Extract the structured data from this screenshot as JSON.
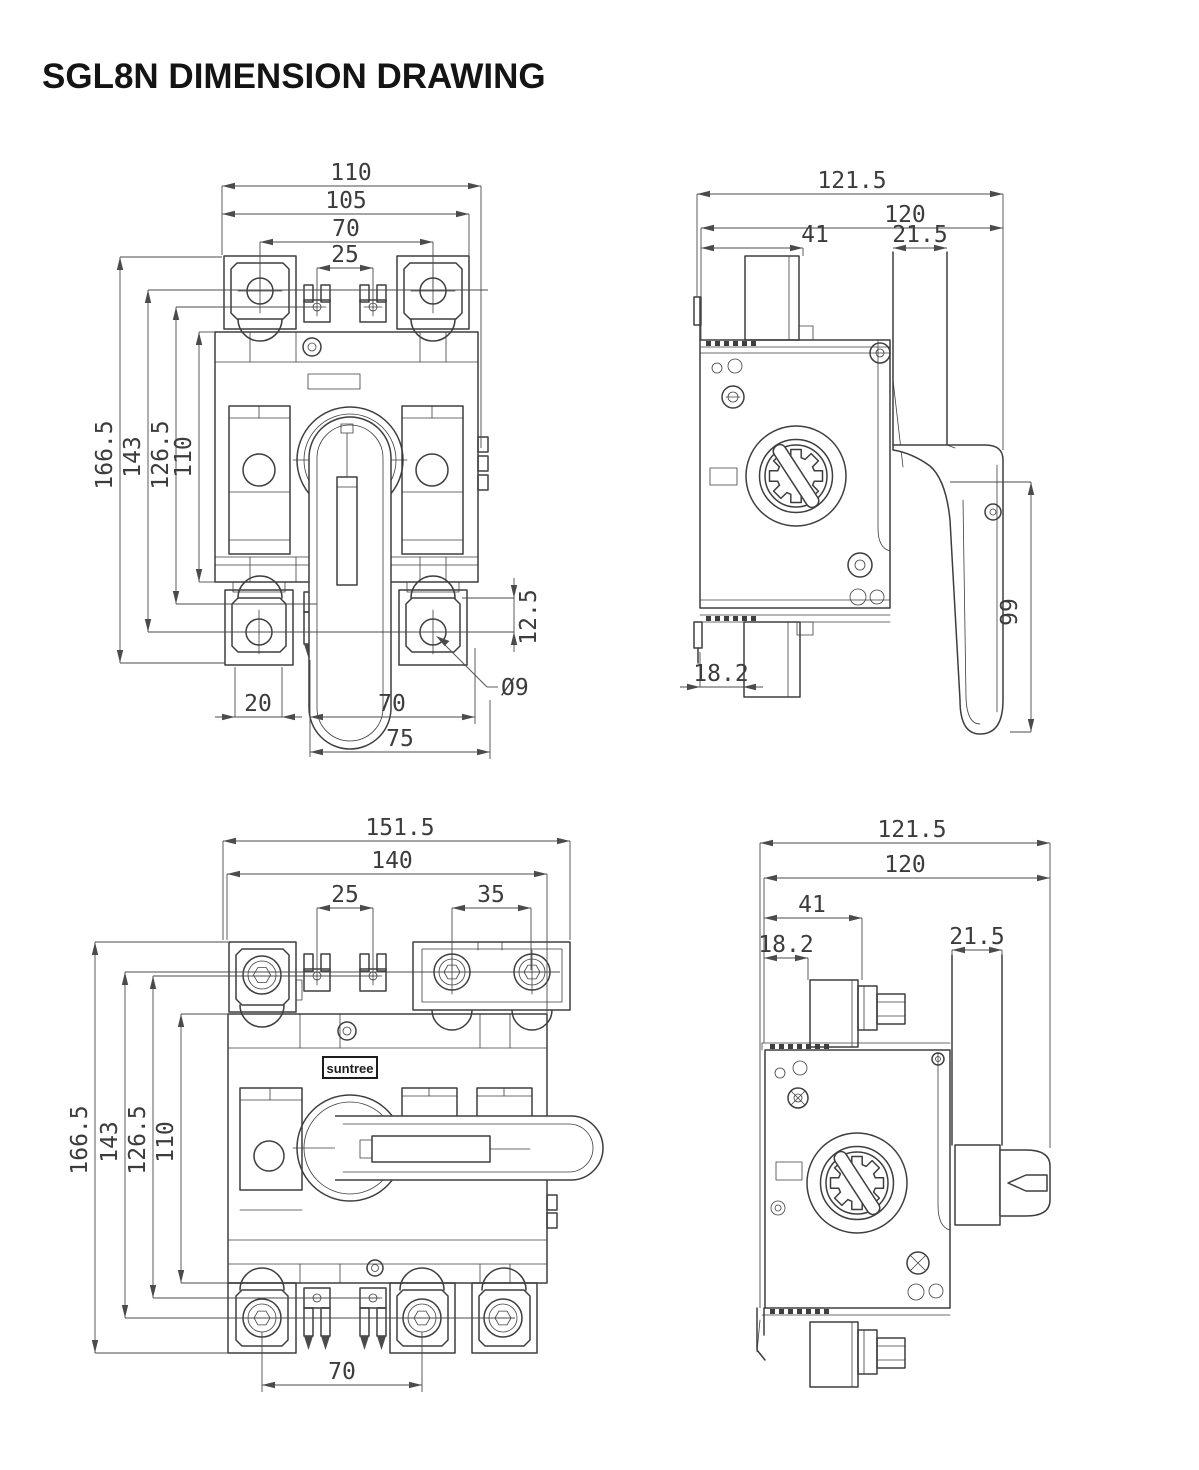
{
  "title": "SGL8N DIMENSION DRAWING",
  "brand_label": "suntree",
  "views": {
    "front_view_2pole": {
      "overall_width": "110",
      "terminal_span": "105",
      "terminal_pitch": "70",
      "clip_pitch": "25",
      "overall_height": "166.5",
      "mount_height": "143",
      "clip_height": "126.5",
      "body_height": "110",
      "terminal_offset": "12.5",
      "hole_diameter": "Ø9",
      "foot_width": "20",
      "handle_span": "70",
      "base_span": "75"
    },
    "side_view_2pole": {
      "overall_depth": "121.5",
      "body_depth": "120",
      "terminal_depth": "41",
      "shaft_width": "21.5",
      "handle_length": "99",
      "rail_offset": "18.2"
    },
    "front_view_3pole": {
      "overall_width": "151.5",
      "body_width": "140",
      "clip_pitch": "25",
      "terminal_pitch": "35",
      "overall_height": "166.5",
      "mount_height": "143",
      "clip_height": "126.5",
      "body_height": "110",
      "pole_pitch": "70"
    },
    "side_view_3pole": {
      "overall_depth": "121.5",
      "body_depth": "120",
      "terminal_depth": "41",
      "rail_offset": "18.2",
      "shaft_width": "21.5"
    }
  }
}
